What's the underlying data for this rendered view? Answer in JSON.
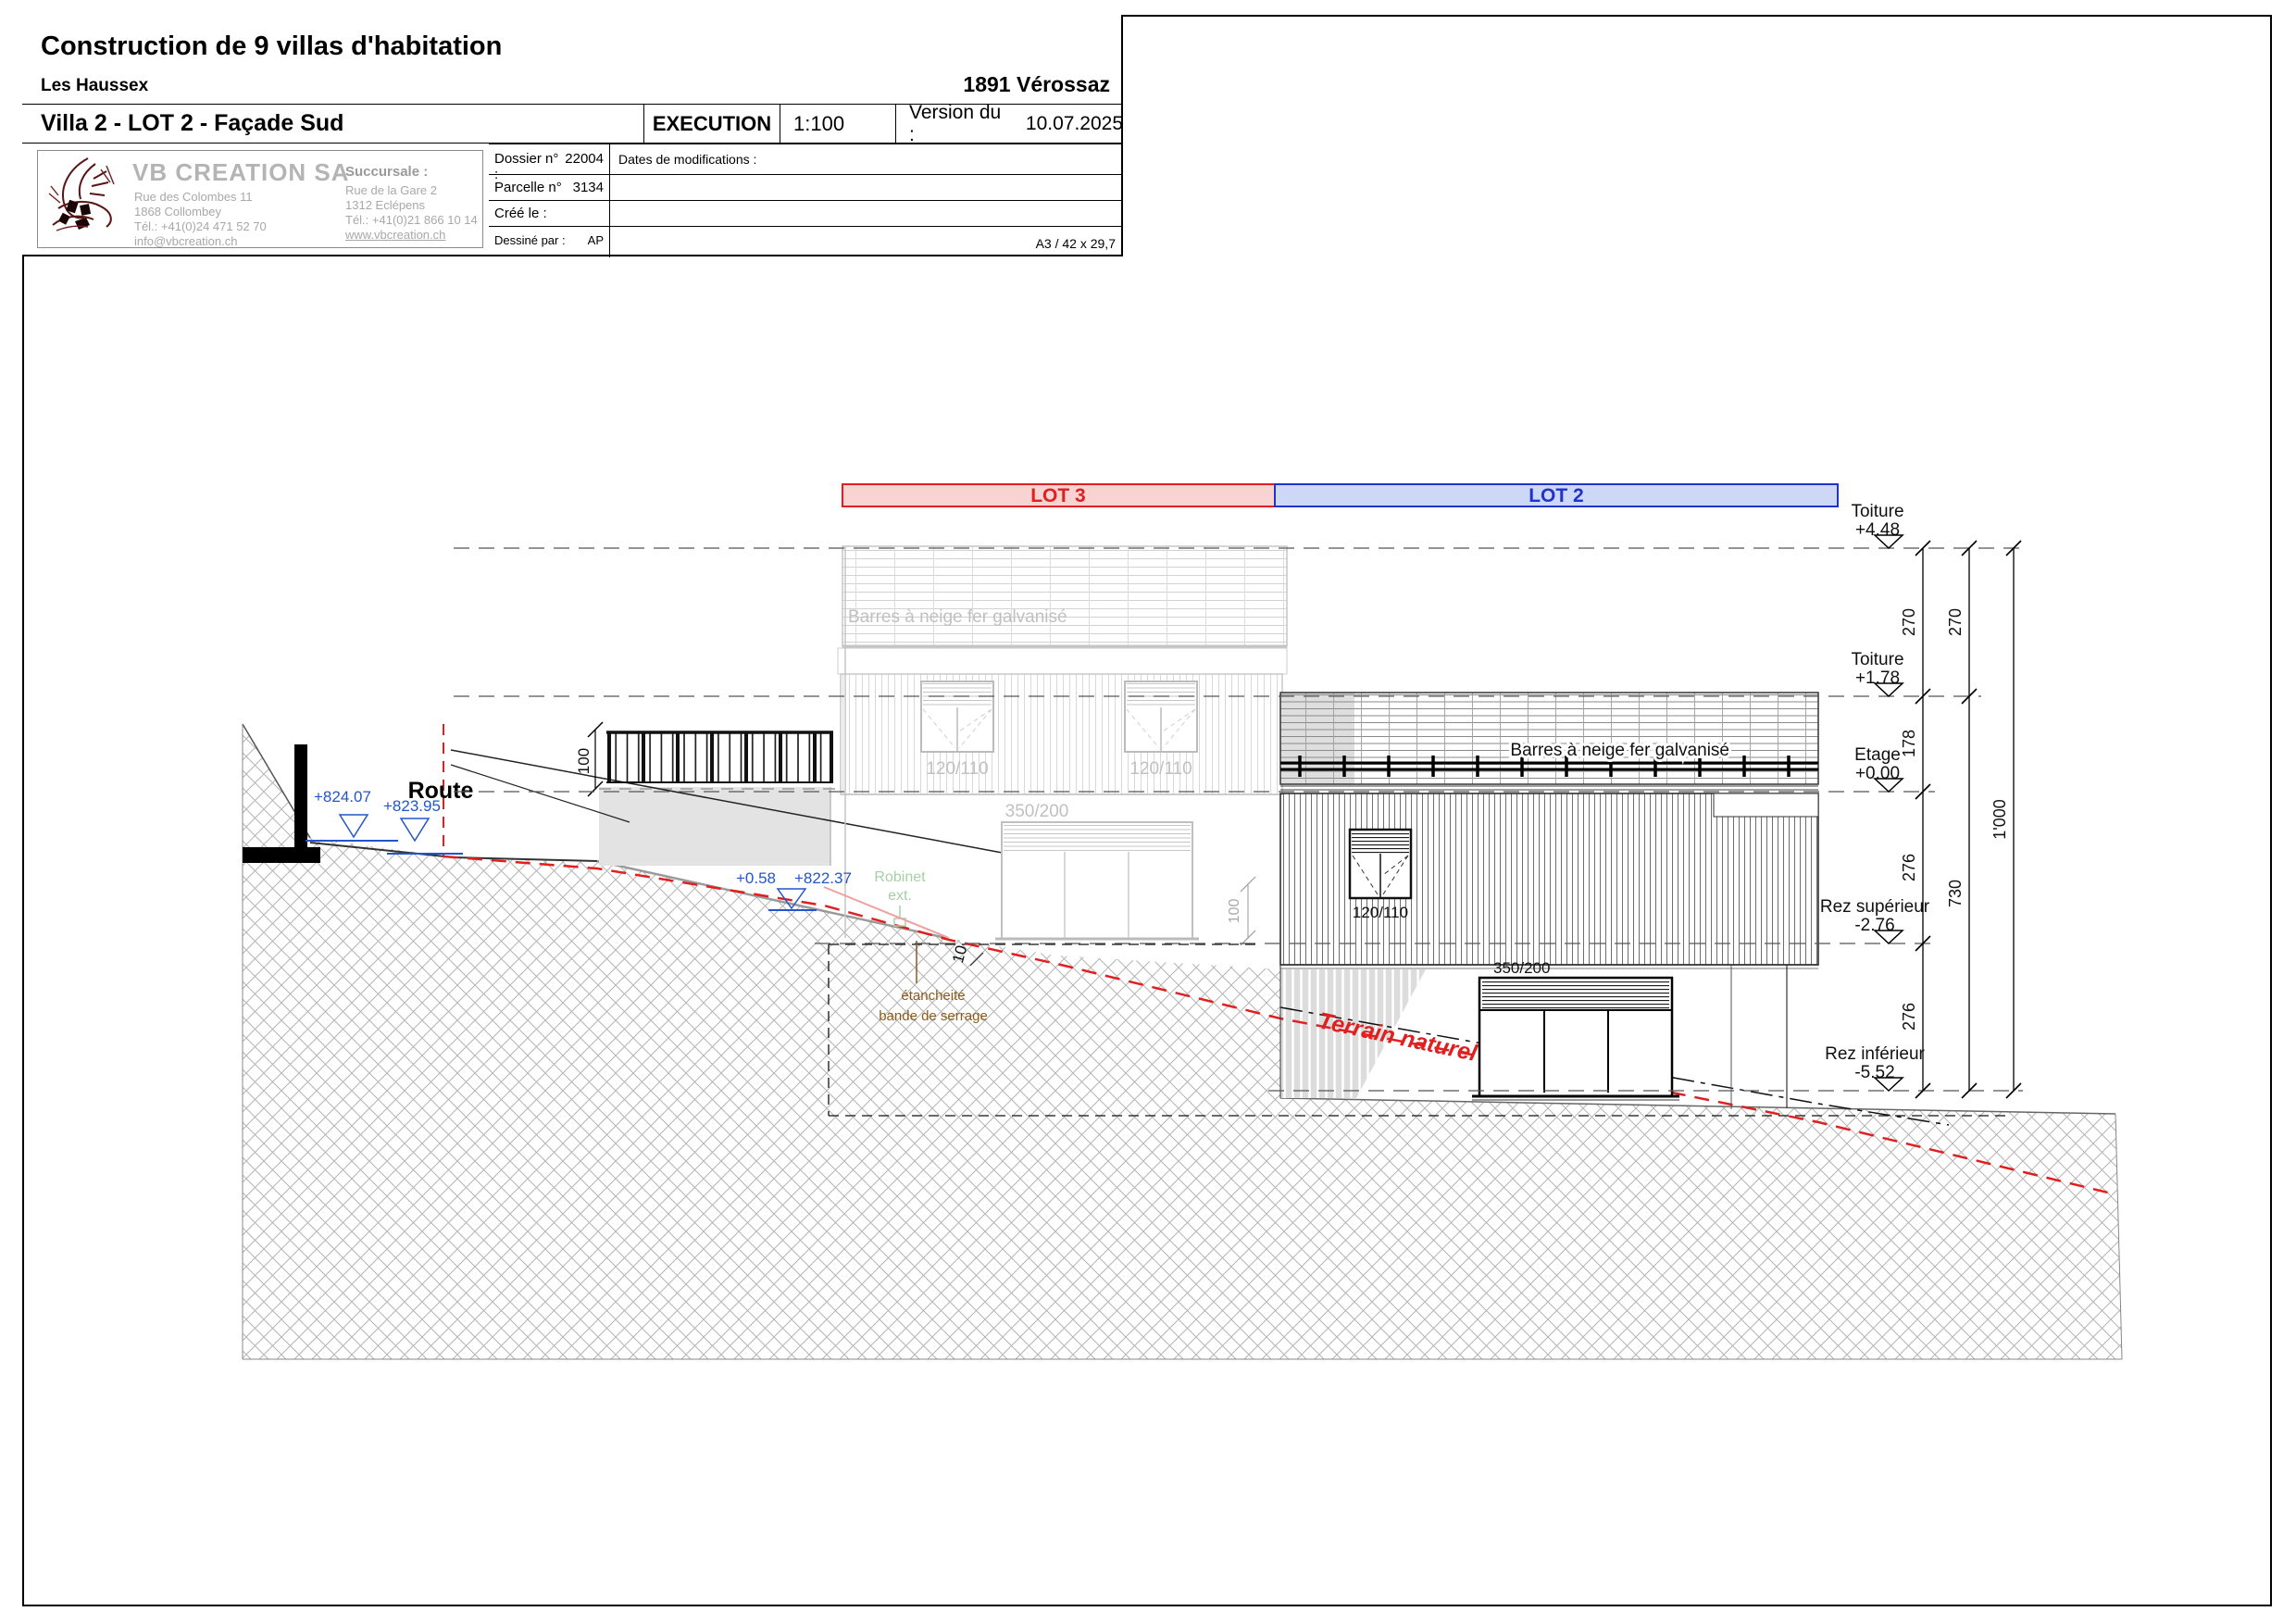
{
  "title_block": {
    "project_title": "Construction de 9 villas d'habitation",
    "project_subtitle": "Les Haussex",
    "location": "1891 Vérossaz",
    "drawing_title": "Villa 2 - LOT 2 - Façade Sud",
    "phase": "EXECUTION",
    "scale": "1:100",
    "version_label": "Version du :",
    "version_date": "10.07.2025",
    "company": {
      "name": "VB CREATION SA",
      "address_line1": "Rue des Colombes 11",
      "address_line2": "1868 Collombey",
      "phone": "Tél.: +41(0)24 471 52 70",
      "email": "info@vbcreation.ch",
      "branch_label": "Succursale :",
      "branch_address_line1": "Rue de la Gare 2",
      "branch_address_line2": "1312 Eclépens",
      "branch_phone": "Tél.: +41(0)21 866 10 14",
      "branch_website": "www.vbcreation.ch"
    },
    "dossier_label": "Dossier n° :",
    "dossier_number": "22004",
    "parcelle_label": "Parcelle n°",
    "parcelle_number": "3134",
    "created_label": "Créé le :",
    "drawn_by_label": "Dessiné par :",
    "drawn_by": "AP",
    "modifications_label": "Dates de modifications :",
    "paper_format": "A3 / 42 x 29,7"
  },
  "drawing": {
    "lots": {
      "lot3": "LOT 3",
      "lot2": "LOT 2"
    },
    "levels": [
      {
        "name": "Toiture",
        "value": "+4.48"
      },
      {
        "name": "Toiture",
        "value": "+1.78"
      },
      {
        "name": "Etage",
        "value": "+0.00"
      },
      {
        "name": "Rez supérieur",
        "value": "-2.76"
      },
      {
        "name": "Rez inférieur",
        "value": "-5.52"
      }
    ],
    "dims": {
      "col1": [
        "270",
        "178",
        "276",
        "276"
      ],
      "col2": [
        "270",
        "730"
      ],
      "col3": [
        "1'000"
      ]
    },
    "annotations": {
      "route": "Route",
      "snow_bars": "Barres à neige fer galvanisé",
      "window_label": "120/110",
      "door_label": "350/200",
      "robinet_line1": "Robinet",
      "robinet_line2": "ext.",
      "etancheite_line1": "étancheité",
      "etancheite_line2": "bande de serrage",
      "terrain_naturel": "Terrain naturel",
      "terrain_amenage": "Terrain aménagé",
      "level_824_07": "+824.07",
      "level_823_95": "+823.95",
      "level_plus_058": "+0.58",
      "level_822_37": "+822.37",
      "dim_100": "100",
      "dim_10": "10"
    },
    "colors": {
      "lot3_fill": "#f9d2d2",
      "lot3_stroke": "#e02020",
      "lot2_fill": "#cdd7f6",
      "lot2_stroke": "#2233cc",
      "terrain_naturel_red": "#e02020",
      "marker_blue": "#2255cc",
      "annotation_brown": "#8a5a1a",
      "robinet_green": "#9fcf9f",
      "faded_gray": "#c3c3c3"
    }
  }
}
